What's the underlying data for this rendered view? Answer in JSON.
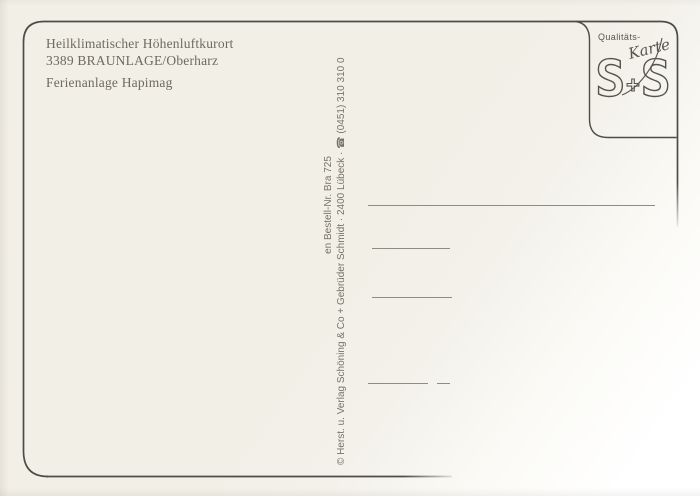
{
  "postcard": {
    "caption": {
      "line1": "Heilklimatischer Höhenluftkurort",
      "line2": "3389 BRAUNLAGE/Oberharz",
      "line3": "Ferienanlage Hapimag"
    },
    "quality_mark": {
      "label": "Qualitäts-",
      "script_label": "Karte",
      "monogram_left": "S",
      "monogram_plus": "+",
      "monogram_right": "S"
    },
    "publisher": {
      "order_line": "en Bestell-Nr. Bra 725",
      "imprint_line": "© Herst. u. Verlag Schöning & Co + Gebrüder Schmidt · 2400 Lübeck · ☎ (0451) 310 310 0"
    },
    "colors": {
      "paper": "#f2efe7",
      "frame_line": "#4e4c46",
      "ruled_line": "#8f8c85",
      "ink": "#6e6a61",
      "mark_ink": "#57544b"
    }
  }
}
